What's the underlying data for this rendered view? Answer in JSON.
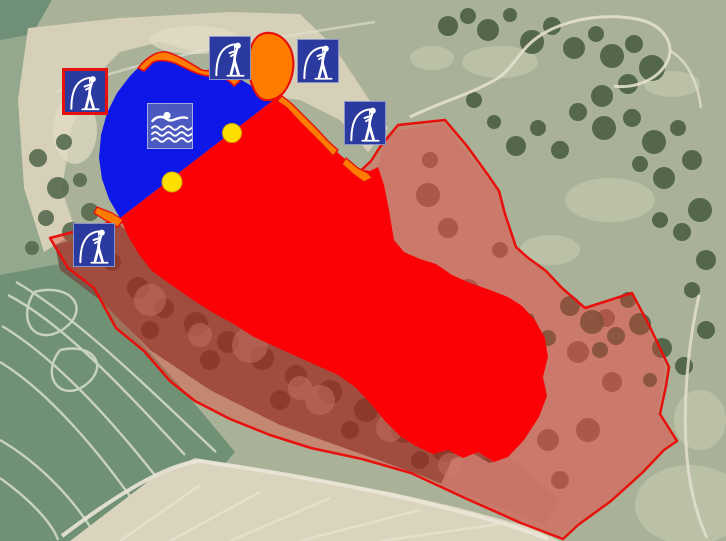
{
  "app": {
    "name": "lake-zoning-aerial-map",
    "view": "satellite-overlay"
  },
  "zones": {
    "swimming_water": {
      "id": "swimming-allowed-water",
      "color": "#0d17e8"
    },
    "restricted_water": {
      "id": "restricted-water-area",
      "color": "#fb0105"
    },
    "protected_land": {
      "id": "protected-land-zone",
      "outline_color": "#e8100c",
      "fill_color": "rgba(244,58,44,0.35)"
    },
    "shore_strip": {
      "id": "shore-strip",
      "color": "#ff7c00",
      "outline_color": "#e8100c"
    },
    "pond": {
      "id": "small-pond",
      "color": "#ff7c00",
      "outline_color": "#e8100c"
    }
  },
  "markers": {
    "fishing": [
      {
        "icon": "angler-icon",
        "variant": "red-border",
        "x": 62,
        "y": 68
      },
      {
        "icon": "angler-icon",
        "variant": "plain",
        "x": 209,
        "y": 36
      },
      {
        "icon": "angler-icon",
        "variant": "plain",
        "x": 297,
        "y": 39
      },
      {
        "icon": "angler-icon",
        "variant": "plain",
        "x": 344,
        "y": 101
      },
      {
        "icon": "angler-icon",
        "variant": "plain",
        "x": 73,
        "y": 223
      }
    ],
    "swimming": {
      "icon": "swimmer-icon",
      "x": 147,
      "y": 103
    },
    "buoys": [
      {
        "x": 232,
        "y": 133,
        "r": 9.5
      },
      {
        "x": 172,
        "y": 182,
        "r": 10
      }
    ],
    "colors": {
      "icon_blue": "#2b3a9e",
      "swim_icon_blue": "#525fbc",
      "buoy_yellow": "#ffe400",
      "border_red": "#e8100c"
    }
  }
}
